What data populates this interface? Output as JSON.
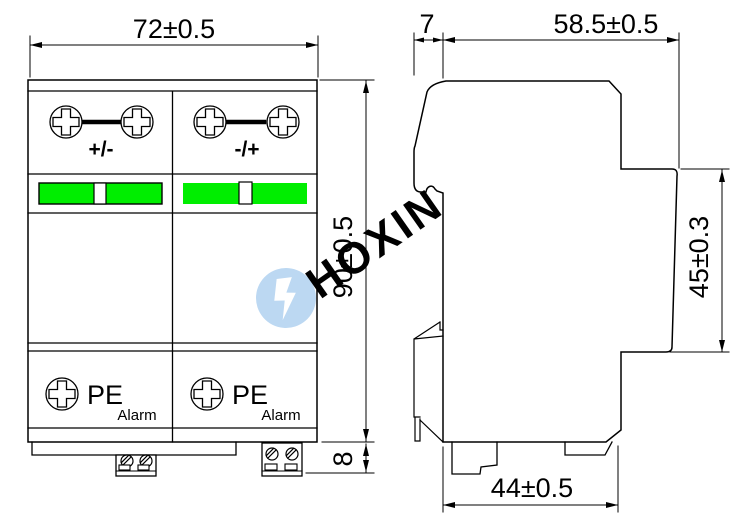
{
  "front_view": {
    "dim_width": "72±0.5",
    "dim_height": "90±0.5",
    "dim_terminal_height": "8",
    "modules": [
      {
        "polarity": "+/-",
        "ground": "PE",
        "alarm": "Alarm"
      },
      {
        "polarity": "-/+",
        "ground": "PE",
        "alarm": "Alarm"
      }
    ]
  },
  "side_view": {
    "dim_top_offset": "7",
    "dim_depth": "58.5±0.5",
    "dim_upper_height": "45±0.3",
    "dim_base_depth": "44±0.5"
  },
  "watermark": {
    "text": "HOXIN"
  },
  "colors": {
    "indicator_green": "#00ee00",
    "watermark_blue": "#bcd8f2",
    "line": "#000000"
  }
}
